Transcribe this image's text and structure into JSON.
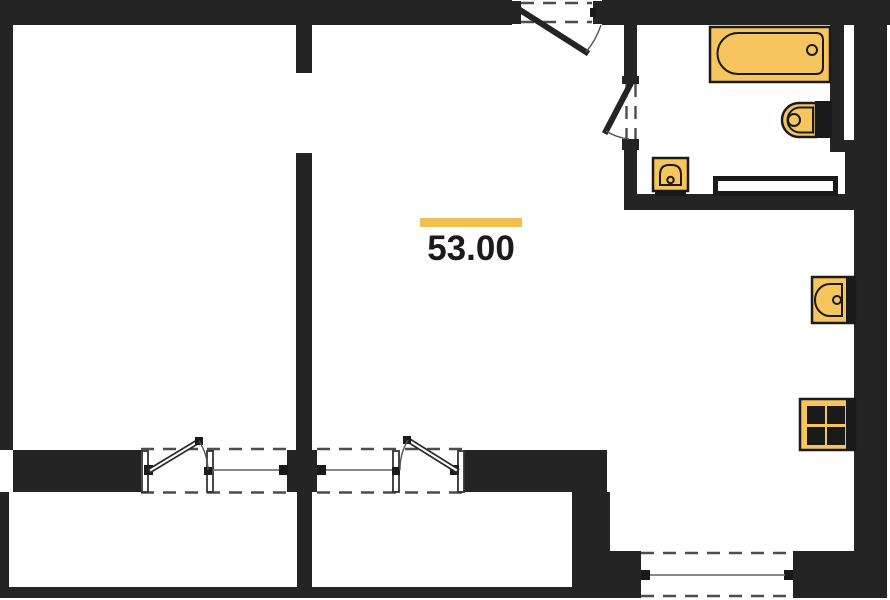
{
  "plan": {
    "area_label": "53.00"
  },
  "colors": {
    "background": "#FFFFFF",
    "wall": "#242424",
    "fixture_fill": "#F6C55E",
    "fixture_outline": "#1A1A1A",
    "accent_bar": "#F1C04F",
    "thin_line": "#4D4D4D"
  },
  "legend": {
    "fixtures": [
      "bathtub",
      "toilet",
      "washbasin",
      "radiator",
      "kitchen-sink",
      "stove"
    ],
    "doors": [
      "entrance-door",
      "bathroom-door",
      "balcony-door-left",
      "balcony-door-right",
      "interior-doorway"
    ],
    "windows": [
      "window-left-room",
      "window-living-room",
      "window-bottom"
    ]
  }
}
